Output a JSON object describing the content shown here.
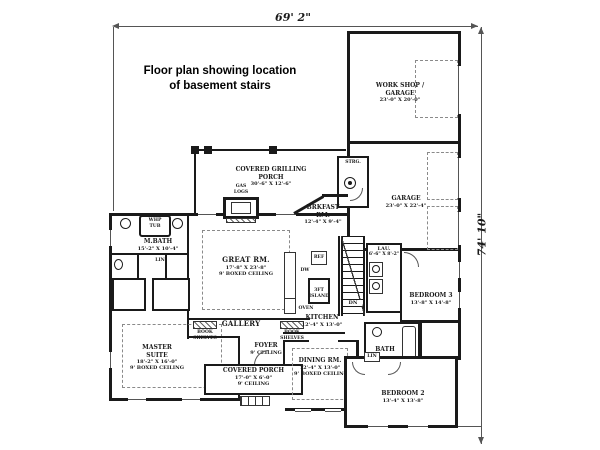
{
  "title": {
    "line1": "Floor plan showing location",
    "line2": "of basement stairs"
  },
  "dimensions": {
    "width": "69' 2\"",
    "height": "74' 10\""
  },
  "rooms": {
    "workshop": {
      "name": "WORK SHOP /",
      "name2": "GARAGE",
      "dims": "23'-0\" X 20'-0\""
    },
    "garage": {
      "name": "GARAGE",
      "dims": "23'-0\" X 22'-4\""
    },
    "strg": {
      "name": "STRG."
    },
    "grilling_porch": {
      "name": "COVERED GRILLING",
      "name2": "PORCH",
      "dims": "30'-6\" X 12'-6\""
    },
    "gas_logs": {
      "line1": "GAS",
      "line2": "LOGS"
    },
    "brkfast": {
      "name": "BRKFAST",
      "name2": "RM.",
      "dims": "12'-4\" X 9'-4\""
    },
    "mbath": {
      "name": "M.BATH",
      "dims": "15'-2\" X 10'-4\""
    },
    "whp_tub": {
      "line1": "WHP",
      "line2": "TUB"
    },
    "lin1": {
      "name": "LIN"
    },
    "lin2": {
      "name": "LIN"
    },
    "great_rm": {
      "name": "GREAT RM.",
      "dims": "17'-8\" X 23'-8\"",
      "note": "9' BOXED CEILING"
    },
    "kitchen": {
      "name": "KITCHEN",
      "dims": "12'-4\" X 13'-0\""
    },
    "island": {
      "line1": "3FT",
      "line2": "ISLAND"
    },
    "ref": {
      "name": "REF"
    },
    "dw": {
      "name": "DW"
    },
    "oven": {
      "name": "OVEN"
    },
    "stairs": {
      "name": "DN"
    },
    "lau": {
      "name": "LAU.",
      "dims": "6'-6\" X 8'-2\""
    },
    "bedroom3": {
      "name": "BEDROOM 3",
      "dims": "13'-8\" X 14'-8\""
    },
    "master": {
      "name": "MASTER",
      "name2": "SUITE",
      "dims": "18'-2\" X 16'-0\"",
      "note": "9' BOXED CEILING"
    },
    "gallery": {
      "name": "GALLERY"
    },
    "book_left": {
      "line1": "BOOK",
      "line2": "SHELVES"
    },
    "book_right": {
      "line1": "BOOK",
      "line2": "SHELVES"
    },
    "foyer": {
      "name": "FOYER",
      "note": "9' CEILING"
    },
    "covered_porch": {
      "name": "COVERED PORCH",
      "dims": "17'-0\" X 6'-0\"",
      "note": "9' CEILING"
    },
    "dining": {
      "name": "DINING RM.",
      "dims": "12'-4\" X 13'-0\"",
      "note": "9' BOXED CEILING"
    },
    "bath": {
      "name": "BATH"
    },
    "bedroom2": {
      "name": "BEDROOM 2",
      "dims": "13'-4\" X 13'-8\""
    }
  },
  "colors": {
    "line": "#1a1a1a",
    "background": "#ffffff"
  }
}
